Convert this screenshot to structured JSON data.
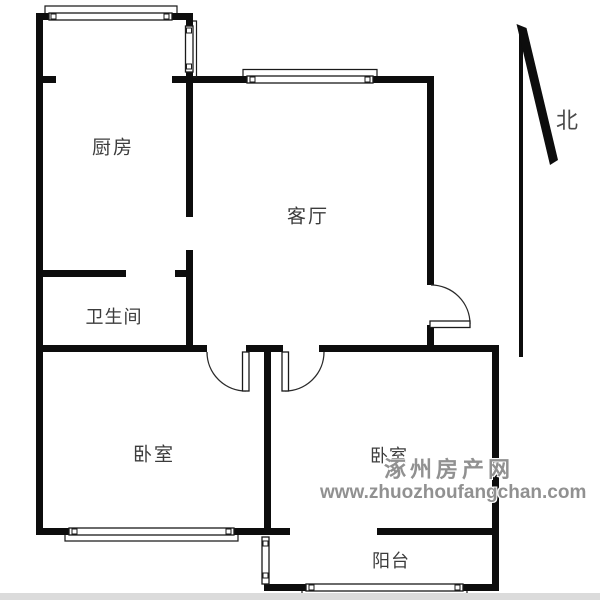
{
  "plan": {
    "rooms": {
      "kitchen": "厨房",
      "living_room": "客厅",
      "bathroom": "卫生间",
      "bedroom_left": "卧室",
      "bedroom_right": "卧室",
      "balcony": "阳台"
    },
    "compass": {
      "north_label": "北"
    }
  },
  "watermark": {
    "site_name": "涿州房产网",
    "site_url": "www.zhuozhoufangchan.com"
  },
  "colors": {
    "wall": "#0d0d0d",
    "room_label": "#3c3c3c",
    "watermark": "#919191",
    "footer_bar": "#dbdbdb",
    "background": "#ffffff"
  }
}
